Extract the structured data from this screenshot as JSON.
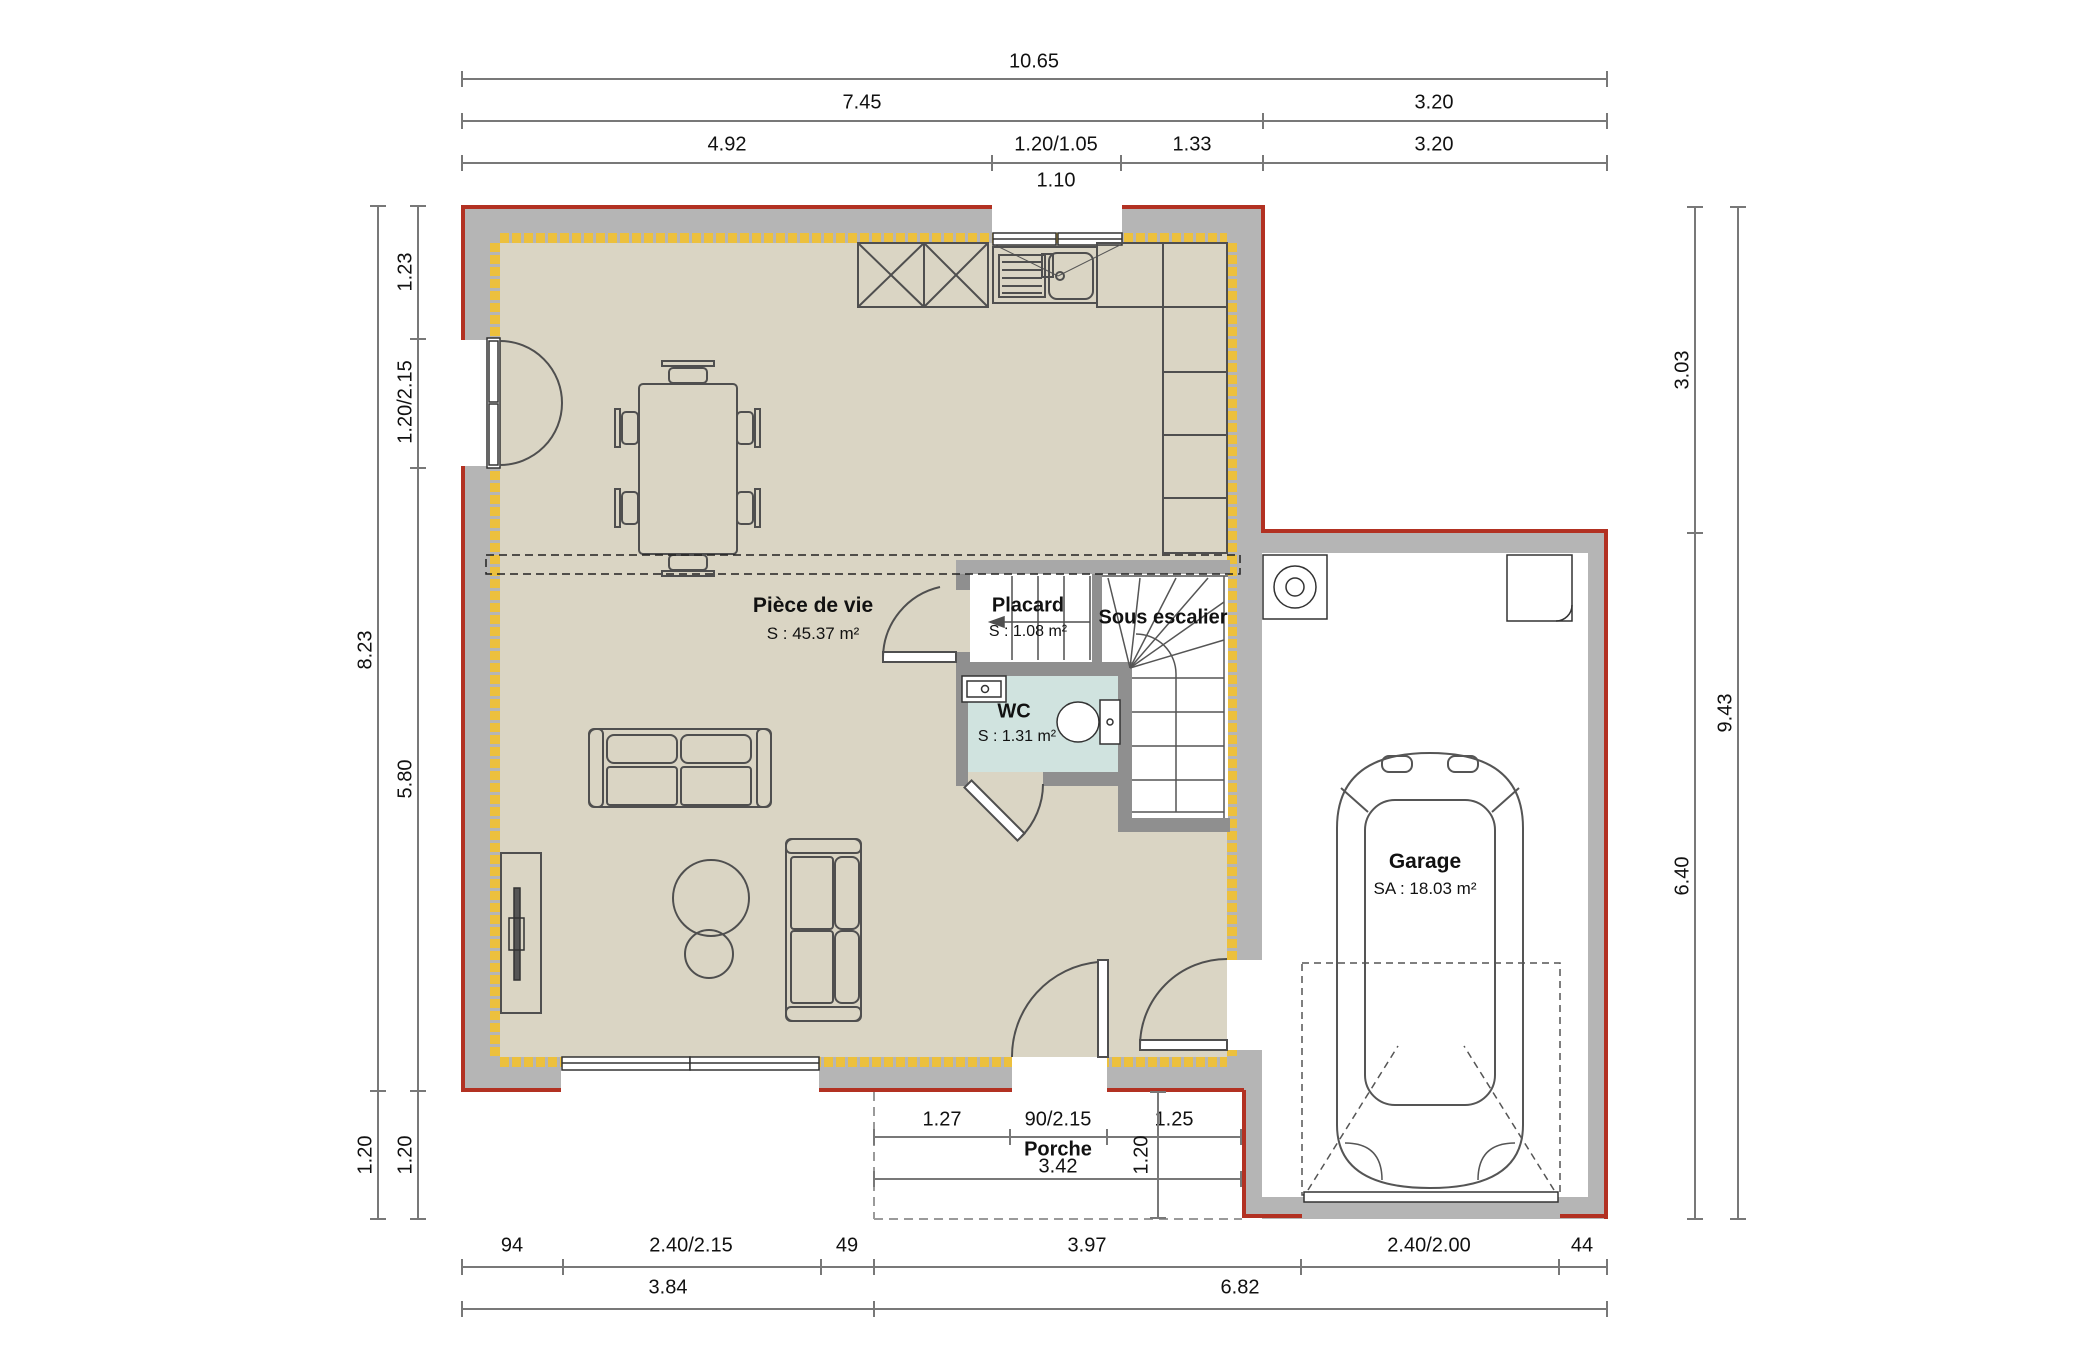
{
  "colors": {
    "floor": "#dad5c4",
    "wall": "#b5b5b5",
    "partition": "#8f8f8f",
    "insulation": "#ecc03d",
    "exterior_line": "#b23122",
    "wc_floor": "#d0e3df",
    "linework": "#4f4f4f",
    "dim_line": "#787878"
  },
  "rooms": {
    "living": {
      "name": "Pièce de vie",
      "area": "S : 45.37 m²"
    },
    "placard": {
      "name": "Placard",
      "area": "S : 1.08 m²"
    },
    "under_stairs": {
      "name": "Sous escalier"
    },
    "wc": {
      "name": "WC",
      "area": "S : 1.31 m²"
    },
    "garage": {
      "name": "Garage",
      "area": "SA : 18.03 m²"
    },
    "porch": {
      "name": "Porche"
    }
  },
  "dims": {
    "top": {
      "total": "10.65",
      "house": "7.45",
      "garage": "3.20",
      "seg1": "4.92",
      "seg2": "1.20/1.05",
      "seg3": "1.33",
      "seg4": "3.20",
      "window_clear": "1.10"
    },
    "left": {
      "total": "8.23",
      "seg1": "1.23",
      "seg2": "1.20/2.15",
      "seg3": "5.80",
      "porch_a": "1.20",
      "porch_b": "1.20"
    },
    "right": {
      "total": "9.43",
      "seg1": "3.03",
      "seg2": "6.40"
    },
    "bottom": {
      "seg1": "94",
      "seg2": "2.40/2.15",
      "seg3": "49",
      "seg4": "3.97",
      "seg5": "2.40/2.00",
      "seg6": "44",
      "sub1": "3.84",
      "sub2": "6.82"
    },
    "porch": {
      "seg1": "1.27",
      "door": "90/2.15",
      "seg2": "1.25",
      "width": "3.42",
      "depth": "1.20"
    }
  }
}
